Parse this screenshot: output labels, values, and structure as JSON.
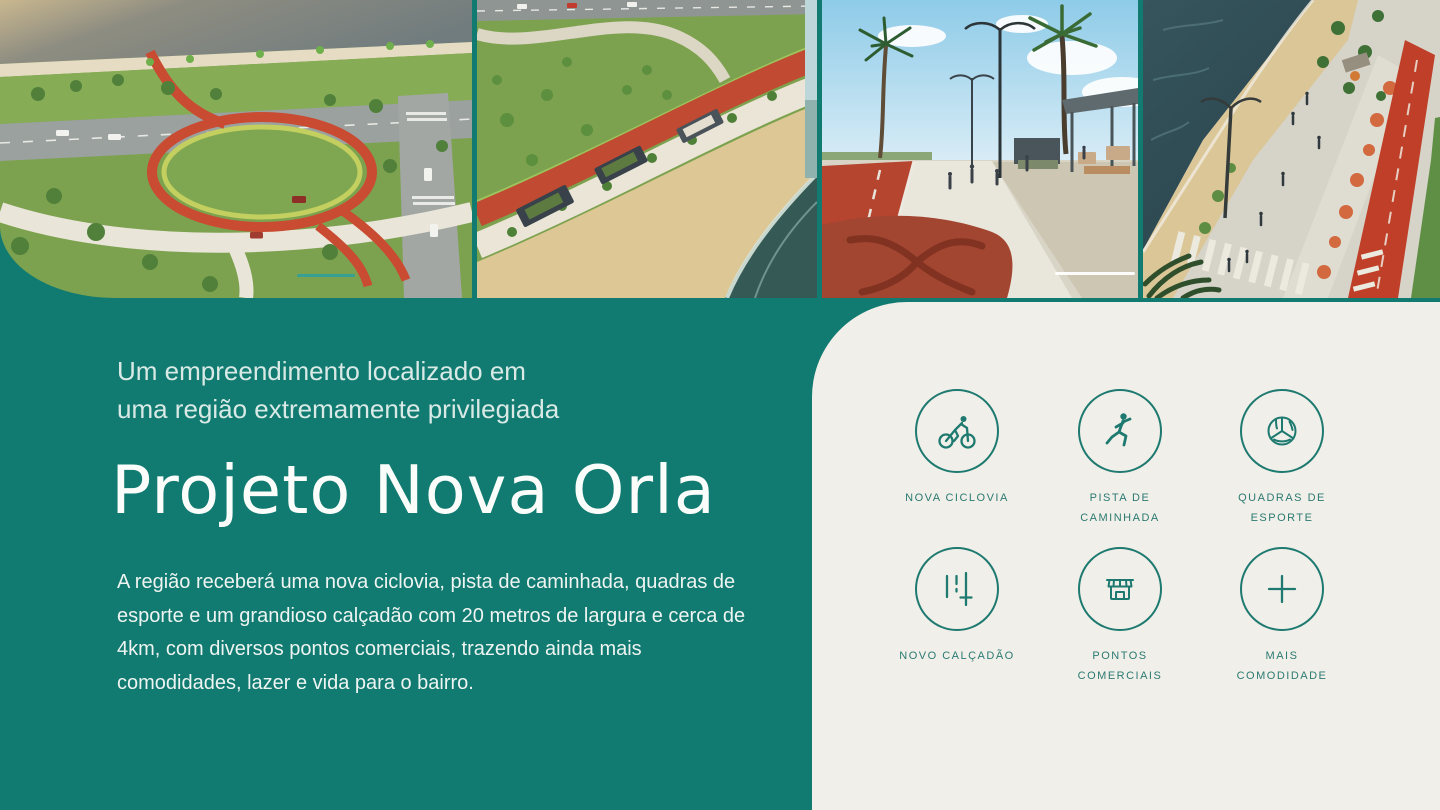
{
  "intro": {
    "kicker": "Um empreendimento localizado em\numa região extremamente privilegiada",
    "title": "Projeto Nova Orla",
    "body": "A região receberá uma nova ciclovia, pista de caminhada, quadras de\nesporte e um grandioso calçadão com 20 metros de largura e cerca de\n4km, com diversos pontos comerciais, trazendo ainda mais\ncomodidades, lazer e vida para o bairro."
  },
  "features": [
    {
      "icon": "bicycle-icon",
      "label": "NOVA CICLOVIA"
    },
    {
      "icon": "runner-icon",
      "label": "PISTA DE\nCAMINHADA"
    },
    {
      "icon": "volleyball-icon",
      "label": "QUADRAS DE\nESPORTE"
    },
    {
      "icon": "lanes-icon",
      "label": "NOVO CALÇADÃO"
    },
    {
      "icon": "storefront-icon",
      "label": "PONTOS\nCOMERCIAIS"
    },
    {
      "icon": "plus-icon",
      "label": "MAIS\nCOMODIDADE"
    }
  ],
  "hero_images": [
    {
      "name": "aerial-park-loop",
      "description": "Aerial render: waterfront park with looping red cycle path"
    },
    {
      "name": "aerial-promenade-kiosks",
      "description": "Aerial render: promenade with kiosks between lawn and beach"
    },
    {
      "name": "street-level-promenade",
      "description": "Street-level render: red cycle path, palms and kiosks"
    },
    {
      "name": "aerial-beach-avenue",
      "description": "Aerial render: beach, boardwalk, crosswalk and red bike lane"
    }
  ],
  "colors": {
    "teal_background": "#117a71",
    "card_background": "#f1efe9",
    "icon_teal": "#1e7a70",
    "title_white": "#fbfdfa"
  }
}
